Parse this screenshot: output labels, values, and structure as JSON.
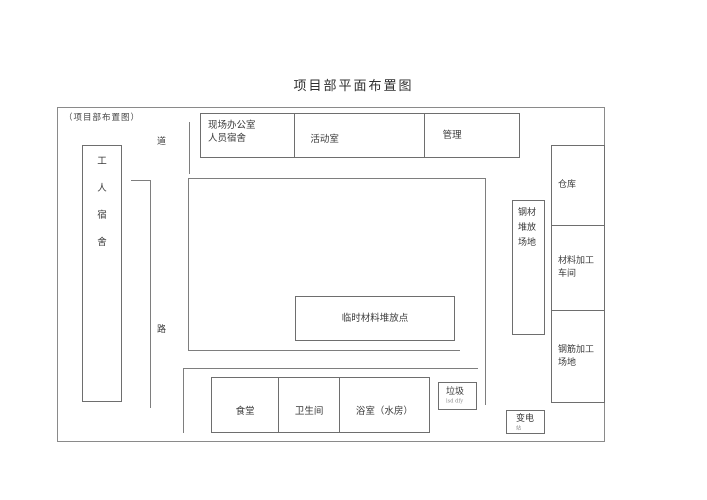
{
  "title": "项目部平面布置图",
  "frame_label": "（项目部布置图）",
  "road": {
    "top_char": "道",
    "bottom_char": "路"
  },
  "worker_dorm": {
    "chars": [
      "工",
      "人",
      "宿",
      "舍"
    ]
  },
  "top_row": {
    "office_line1": "现场办公室",
    "office_line2": "人员宿舍",
    "activity_room": "活动室",
    "management": "管理"
  },
  "central": {
    "temp_material": "临时材料堆放点"
  },
  "facilities": {
    "canteen": "食堂",
    "toilet": "卫生间",
    "bathroom": "浴室（水房）"
  },
  "garbage": {
    "label": "垃圾",
    "sub": "lsd dfy"
  },
  "substation": {
    "label": "变电",
    "sub": "站"
  },
  "right_column": {
    "warehouse": "仓库",
    "material_line1": "材料加工",
    "material_line2": "车间",
    "rebar_line1": "钢筋加工",
    "rebar_line2": "场地"
  },
  "steel_yard": {
    "line1": "钢材",
    "line2": "堆放",
    "line3": "场地"
  },
  "colors": {
    "line": "#7e7e7e",
    "box_border": "#6e6e6e",
    "text": "#3a3a3a",
    "background": "#ffffff"
  }
}
